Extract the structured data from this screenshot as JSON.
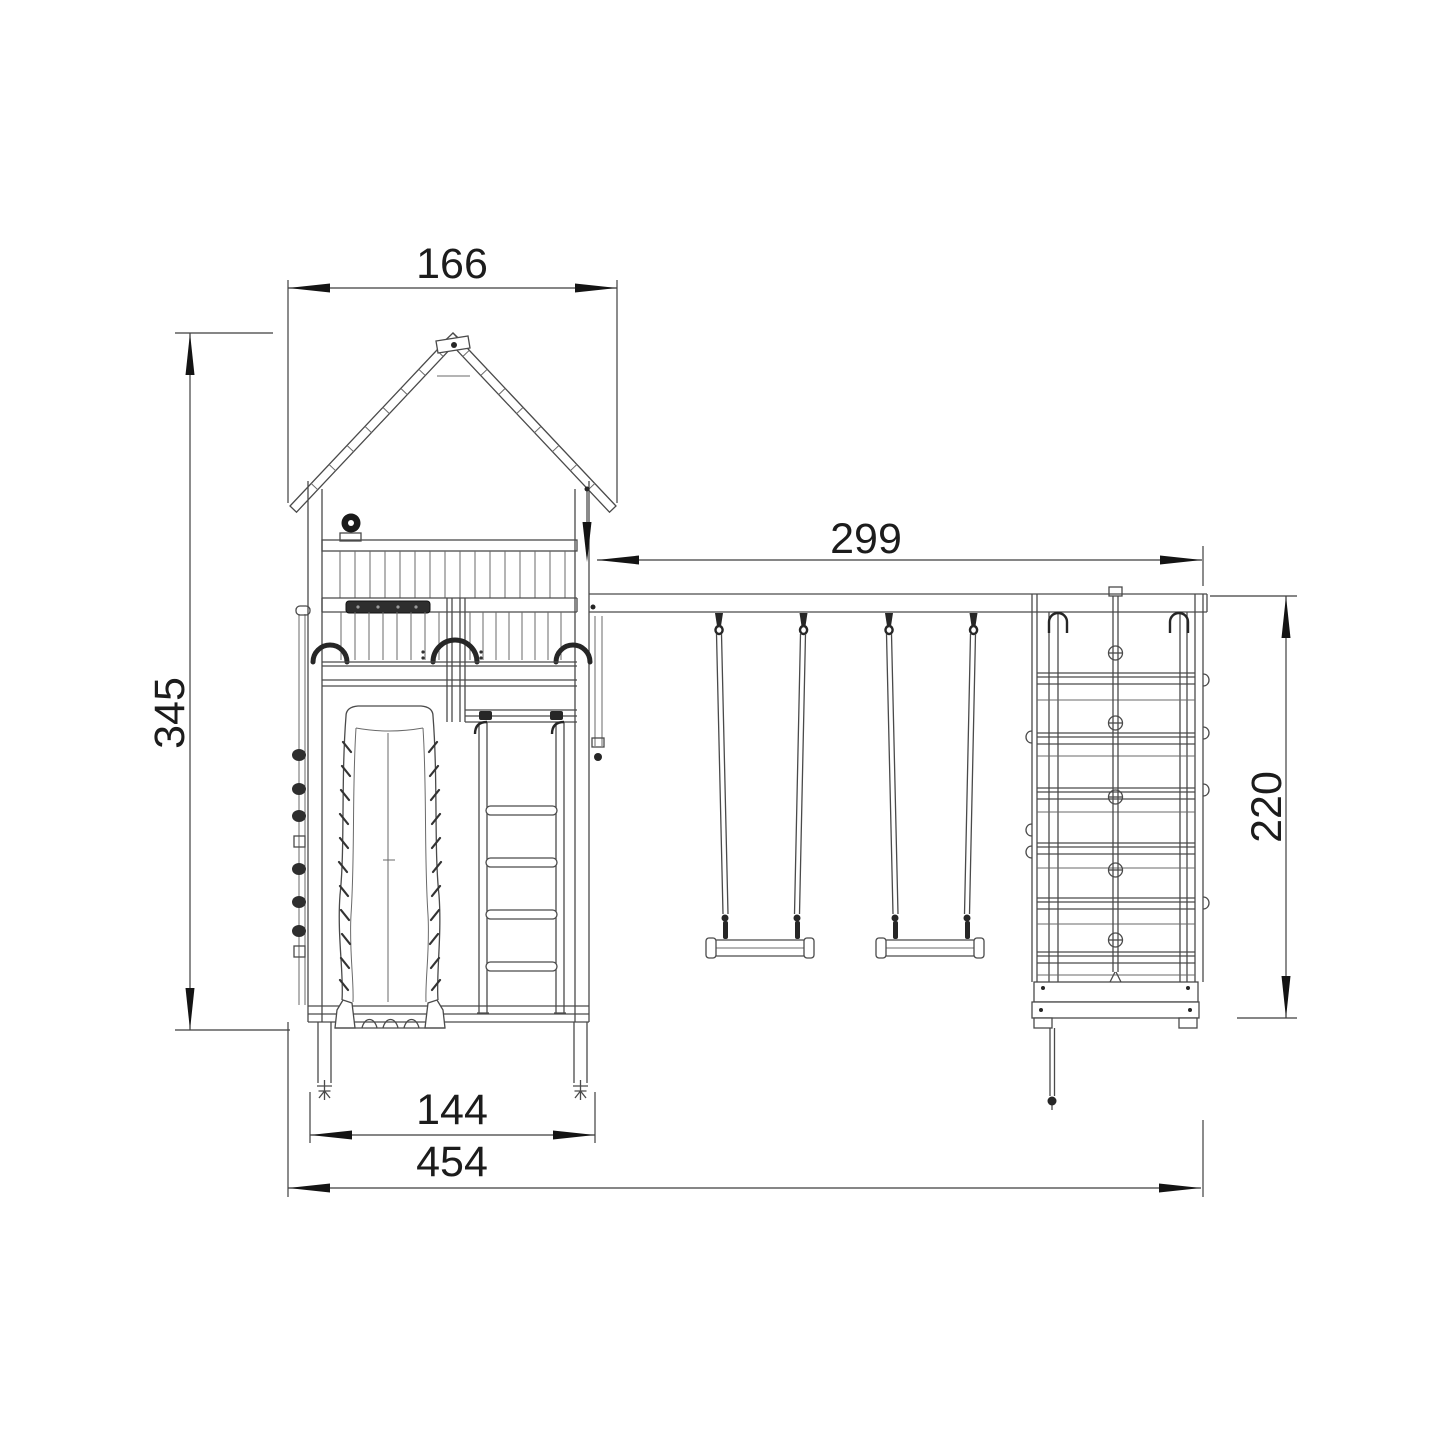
{
  "page": {
    "background": "#ffffff"
  },
  "drawing": {
    "type": "technical dimension drawing, front elevation",
    "subject": "wooden playset: lookout tower with slide, double swing beam and climbing frame",
    "line_color": "#4a4a4a",
    "dark_color": "#1f1f1f",
    "dimensions": {
      "roof_width": {
        "label": "166",
        "orientation": "horizontal",
        "measures": "roof width over the tower"
      },
      "tower_height": {
        "label": "345",
        "orientation": "vertical",
        "measures": "total tower height, roof peak to ground"
      },
      "beam_length": {
        "label": "299",
        "orientation": "horizontal",
        "measures": "swing beam length from tower to climbing frame"
      },
      "frame_height": {
        "label": "220",
        "orientation": "vertical",
        "measures": "climbing frame height, beam to base"
      },
      "tower_base_width": {
        "label": "144",
        "orientation": "horizontal",
        "measures": "tower footprint width between anchors"
      },
      "total_width": {
        "label": "454",
        "orientation": "horizontal",
        "measures": "overall width of the playset"
      }
    },
    "components": [
      "gabled roof with board joints",
      "ridge cap block",
      "steering knob",
      "balustrade with vertical slats",
      "dark grab bar",
      "three porthole arches",
      "front slide with scalloped foot",
      "access ladder with four rungs",
      "climbing holds on left panel",
      "swing beam",
      "two belt swings on ropes",
      "climbing frame with plank wall and knotted rope",
      "base box with feet",
      "ground anchor screws"
    ]
  }
}
